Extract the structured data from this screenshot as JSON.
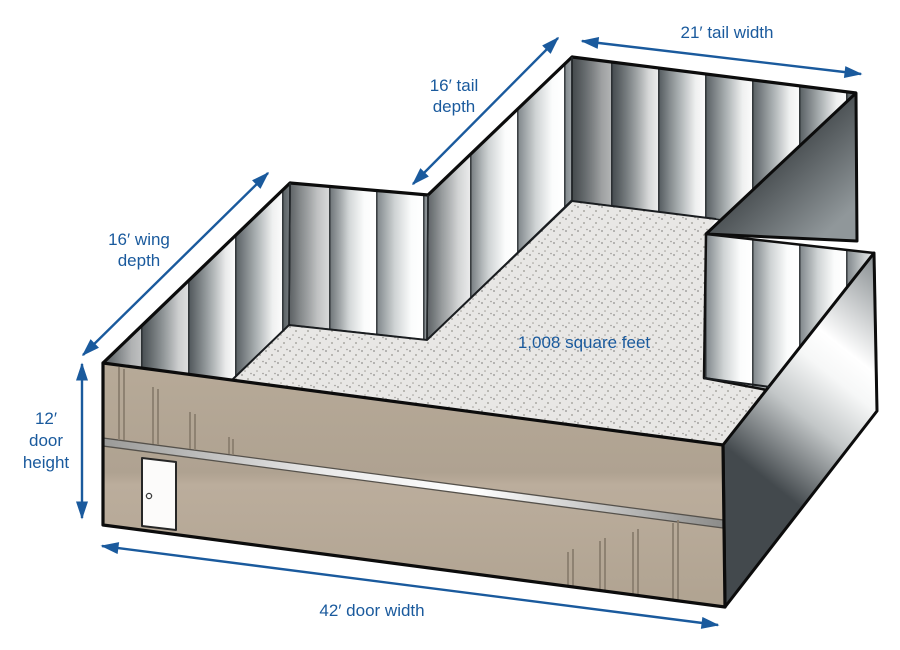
{
  "figure": {
    "background": "#ffffff",
    "area_label": "1,008 square feet",
    "labels": {
      "tail_width": {
        "lines": [
          "21′ tail width"
        ]
      },
      "tail_depth": {
        "lines": [
          "16′ tail",
          "depth"
        ]
      },
      "wing_depth": {
        "lines": [
          "16′ wing",
          "depth"
        ]
      },
      "door_height": {
        "lines": [
          "12′",
          "door",
          "height"
        ]
      },
      "door_width": {
        "lines": [
          "42′ door width"
        ]
      }
    },
    "colors": {
      "annotation_blue": "#1a5a9d",
      "front_wall_tan": "#b3a695",
      "floor_gray": "#e8e7e5",
      "metal_dark": "#3f4549",
      "metal_light": "#ffffff",
      "outline": "#0c0c0c"
    }
  }
}
